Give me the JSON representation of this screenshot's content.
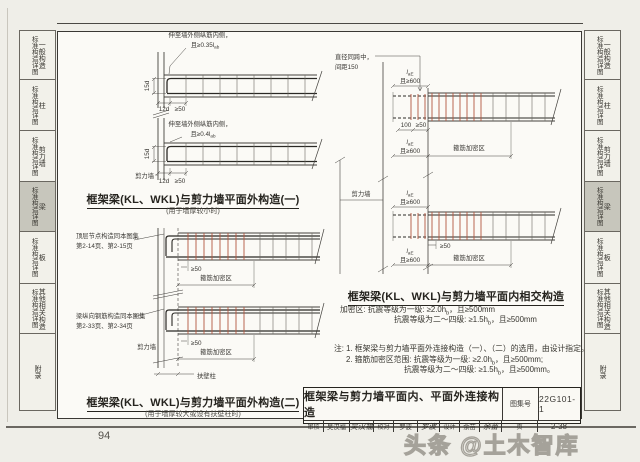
{
  "page": {
    "number": "94",
    "watermark": "头条 @土木智库"
  },
  "colors": {
    "stirrup_red": "#b2563f",
    "tab_active": "#c7c6bc",
    "line_dark": "#3a3834"
  },
  "sidebar": {
    "tabs": [
      {
        "label": "一般构造",
        "suffix": "标准构造详图",
        "active": false
      },
      {
        "label": "柱",
        "suffix": "标准构造详图",
        "active": false
      },
      {
        "label": "剪力墙",
        "suffix": "标准构造详图",
        "active": false
      },
      {
        "label": "梁",
        "suffix": "标准构造详图",
        "active": true
      },
      {
        "label": "板",
        "suffix": "标准构造详图",
        "active": false
      },
      {
        "label": "其他相关构造",
        "suffix": "标准构造详图",
        "active": false
      },
      {
        "label": "附录",
        "suffix": "",
        "active": false
      }
    ]
  },
  "d1": {
    "title": "框架梁(KL、WKL)与剪力墙平面外构造(一)",
    "subtitle": "(用于墙厚较小时)",
    "note1_l1": "伸至墙外侧纵筋内侧，",
    "note1_l2": "且≥0.35l",
    "note1_sub": "ab",
    "note2_l1": "伸至墙外侧纵筋内侧，",
    "note2_l2": "且≥0.4l",
    "note2_sub": "ab",
    "dim_15d": "15d",
    "dim_12d": "12d",
    "dim_ge50": "≥50",
    "wall": "剪力墙"
  },
  "d2": {
    "title": "框架梁(KL、WKL)与剪力墙平面外构造(二)",
    "subtitle": "(用于墙厚较大或设有扶壁柱时)",
    "note1_l1": "顶层节点构造同本图集",
    "note1_l2": "第2-14页、第2-15页",
    "note2_l1": "梁纵向钢筋构造同本图集",
    "note2_l2": "第2-33页、第2-34页",
    "dim_ge50": "≥50",
    "dense": "箍筋加密区",
    "wall": "剪力墙",
    "pilaster": "扶壁柱"
  },
  "d3": {
    "title": "框架梁(KL、WKL)与剪力墙平面内相交构造",
    "note_l1": "直径同跨中，",
    "note_l2": "间距150",
    "laE": "l",
    "laE_sub": "aE",
    "ge600": "且≥600",
    "dim_100": "100",
    "dim_ge50": "≥50",
    "dense": "箍筋加密区",
    "wall": "剪力墙"
  },
  "spec": {
    "l1a": "加密区: 抗震等级为一级: ≥2.0h",
    "l1sub": "b",
    "l1b": "，且≥500mm",
    "l2a": "抗震等级为二～四级: ≥1.5h",
    "l2sub": "b",
    "l2b": "，且≥500mm"
  },
  "notes": {
    "n1": "注: 1. 框架梁与剪力墙平面外连接构造（一）、（二）的选用，由设计指定。",
    "n2a": "2. 箍筋加密区范围: 抗震等级为一级: ≥2.0h",
    "n2sub": "b",
    "n2b": "，且≥500mm;",
    "n3a": "抗震等级为二～四级: ≥1.5h",
    "n3sub": "b",
    "n3b": "，且≥500mm。"
  },
  "titleblock": {
    "title": "框架梁与剪力墙平面内、平面外连接构造",
    "atlas_label": "图集号",
    "atlas_no": "22G101-1",
    "page_label": "页",
    "page_no": "2-38",
    "roles": [
      {
        "label": "审核",
        "name": "吴汉福",
        "sig": "吴汉福"
      },
      {
        "label": "校对",
        "name": "罗波",
        "sig": "罗波"
      },
      {
        "label": "设计",
        "name": "余苗",
        "sig": "余苗"
      }
    ]
  }
}
